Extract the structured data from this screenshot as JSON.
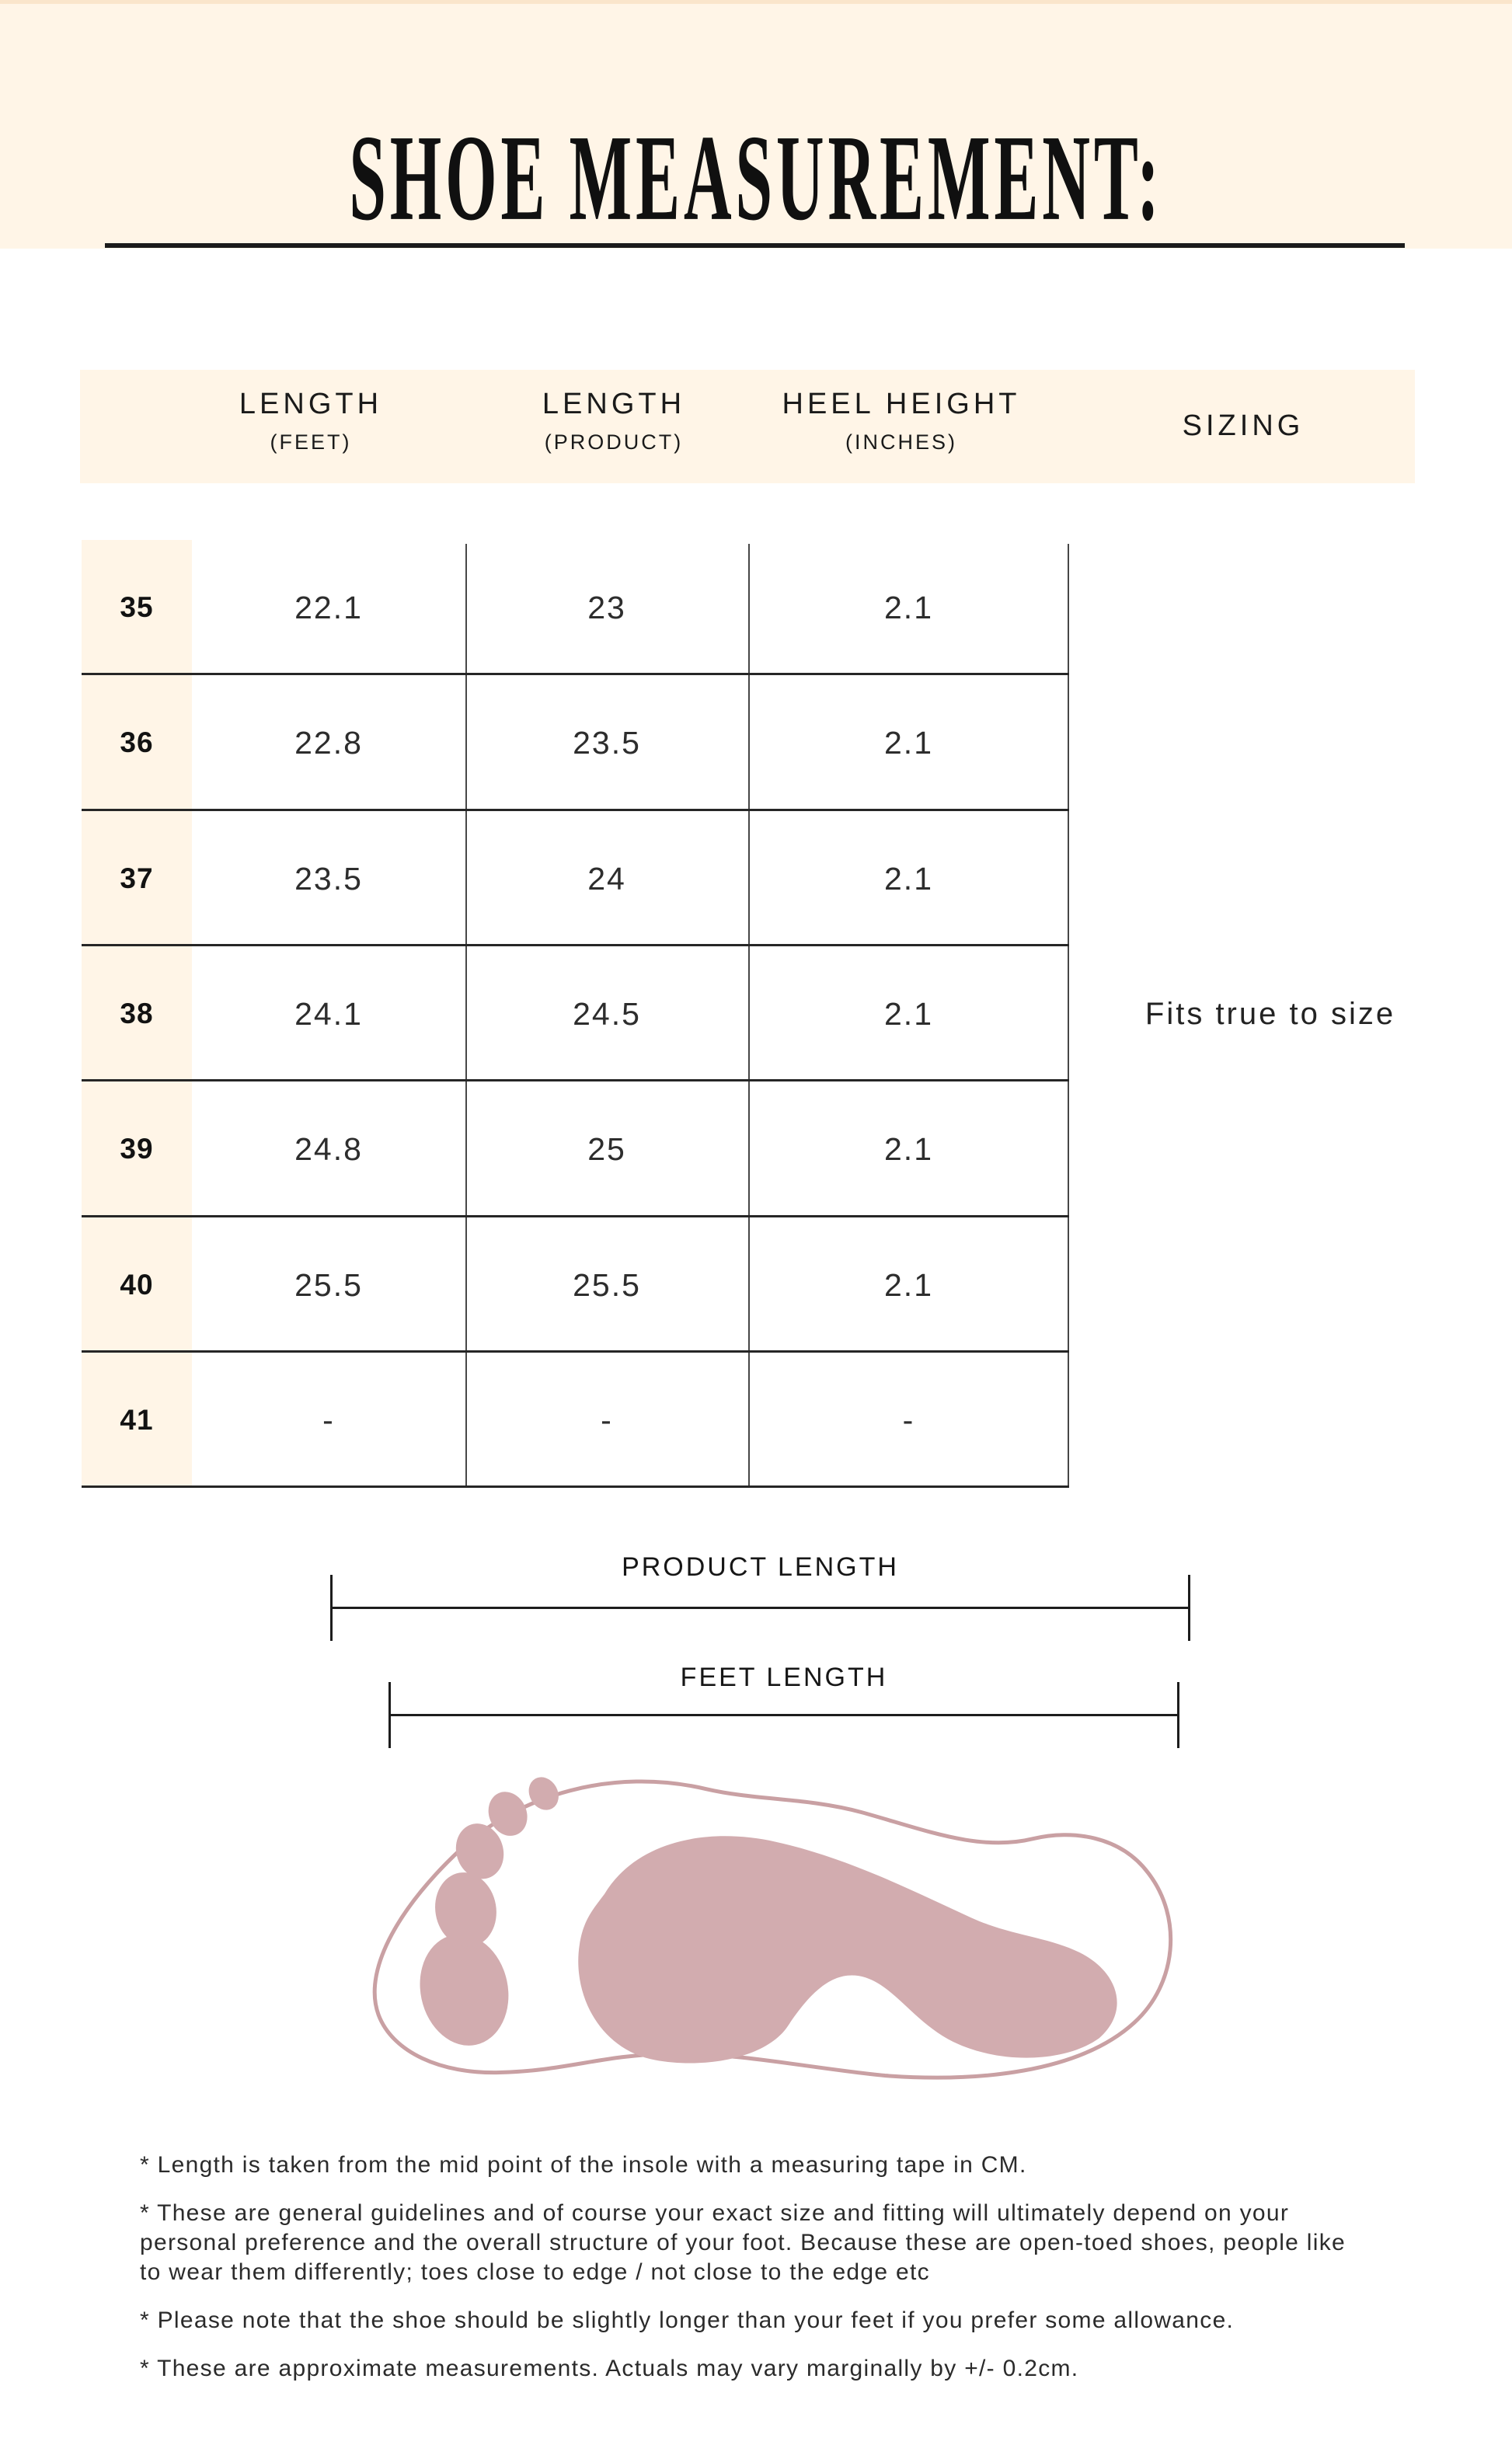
{
  "colors": {
    "background": "#FFFFFF",
    "cream": "#FFF5E7",
    "cream_edge": "#FAE5CB",
    "ink": "#1C1C1C",
    "table_line_dark": "#262626",
    "table_line_gray": "#474747",
    "value_text": "#2D2D2D",
    "foot_fill": "#D2ACAF",
    "foot_outline": "#C9A0A3"
  },
  "header": {
    "title": "SHOE MEASUREMENT:"
  },
  "table": {
    "columns": [
      {
        "label": "LENGTH",
        "sub": "(FEET)"
      },
      {
        "label": "LENGTH",
        "sub": "(PRODUCT)"
      },
      {
        "label": "HEEL HEIGHT",
        "sub": "(INCHES)"
      },
      {
        "label": "SIZING",
        "sub": ""
      }
    ],
    "rows": [
      {
        "size": "35",
        "feet": "22.1",
        "product": "23",
        "heel": "2.1"
      },
      {
        "size": "36",
        "feet": "22.8",
        "product": "23.5",
        "heel": "2.1"
      },
      {
        "size": "37",
        "feet": "23.5",
        "product": "24",
        "heel": "2.1"
      },
      {
        "size": "38",
        "feet": "24.1",
        "product": "24.5",
        "heel": "2.1"
      },
      {
        "size": "39",
        "feet": "24.8",
        "product": "25",
        "heel": "2.1"
      },
      {
        "size": "40",
        "feet": "25.5",
        "product": "25.5",
        "heel": "2.1"
      },
      {
        "size": "41",
        "feet": "-",
        "product": "-",
        "heel": "-"
      }
    ],
    "sizing_value": "Fits true to size"
  },
  "diagram": {
    "product_length_label": "PRODUCT LENGTH",
    "feet_length_label": "FEET LENGTH"
  },
  "footnotes": [
    "* Length is taken from the mid point of the insole with a measuring tape in CM.",
    "* These are general guidelines and of course your exact size and fitting will ultimately depend on your personal preference and the overall structure of your foot. Because these are open-toed shoes, people like to wear them differently; toes close to edge / not close to the edge etc",
    "* Please note that the shoe should be slightly longer than your feet if you prefer some allowance.",
    "* These are approximate measurements. Actuals may vary marginally by +/- 0.2cm."
  ]
}
